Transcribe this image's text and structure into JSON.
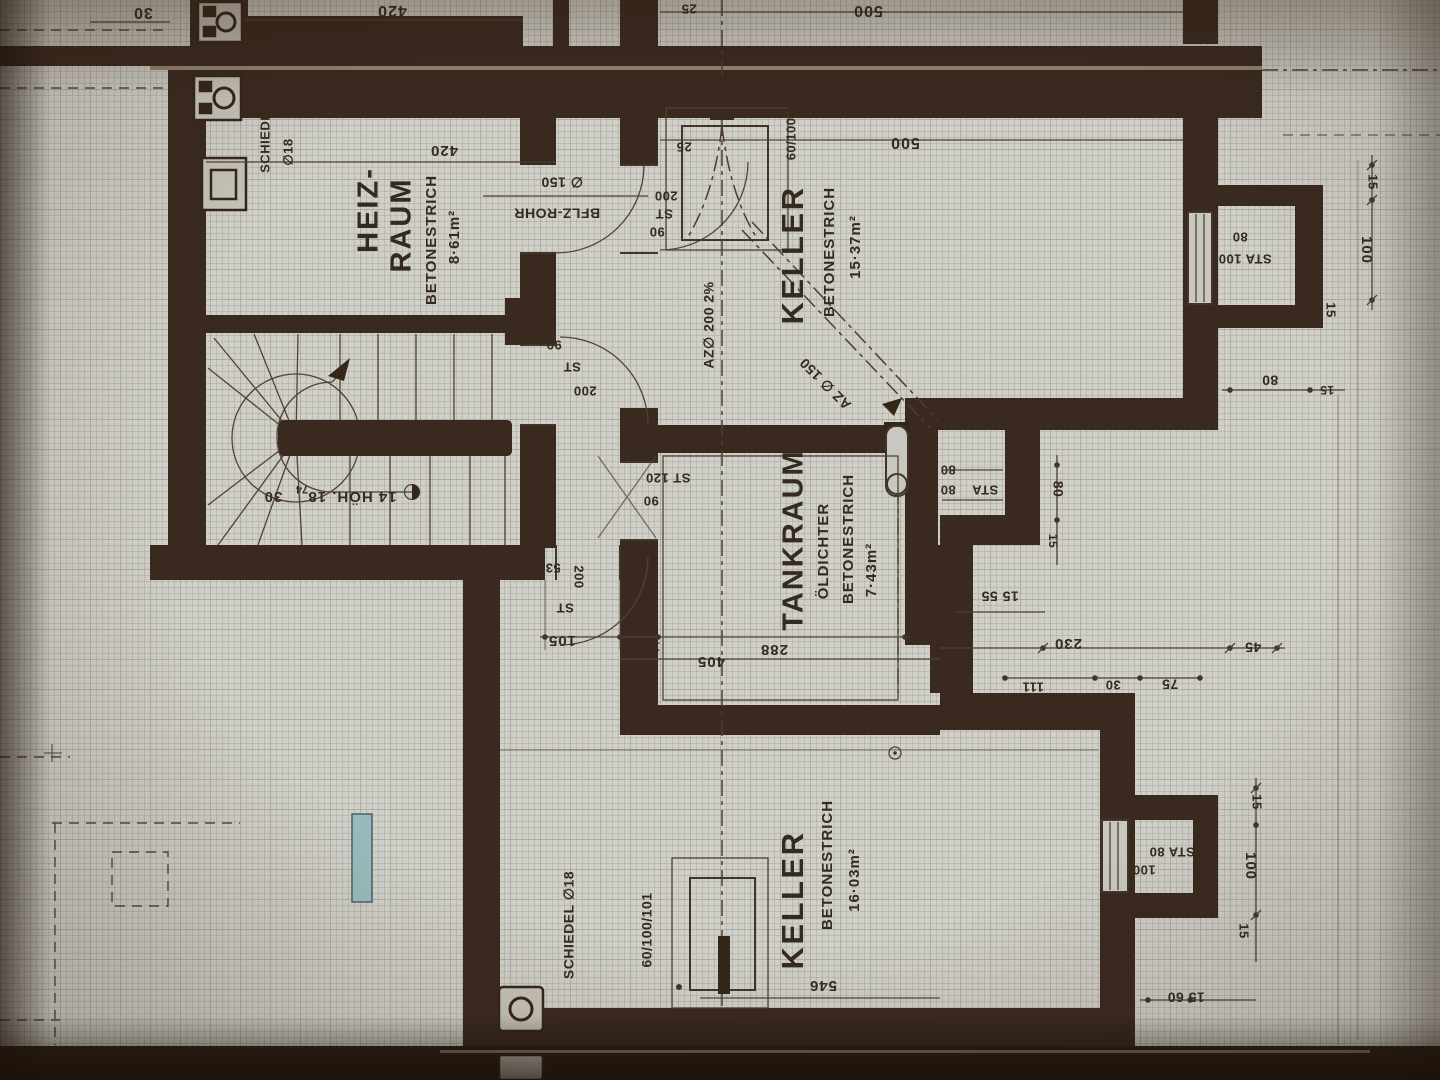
{
  "document": {
    "kind": "Basement floor plan (photographed architectural drawing, German labels)"
  },
  "rooms": {
    "heizraum": {
      "name_l1": "HEIZ-",
      "name_l2": "RAUM",
      "floor": "BETONESTRICH",
      "area": "8·61m²"
    },
    "keller_top": {
      "name": "KELLER",
      "floor": "BETONESTRICH",
      "area": "15·37m²"
    },
    "tankraum": {
      "name": "TANKRAUM",
      "spec": "ÖLDICHTER",
      "floor": "BETONESTRICH",
      "area": "7·43m²"
    },
    "keller_bottom": {
      "name": "KELLER",
      "floor": "BETONESTRICH",
      "area": "16·03m²"
    }
  },
  "stair": {
    "note_main": "14 HÖH. 18",
    "note_sup": "74",
    "note_tread": "30"
  },
  "chimneys": {
    "top_l1": "SCHIEDEL",
    "top_l2": "∅18",
    "bottom": "SCHIEDEL ∅18"
  },
  "doors": {
    "keller_top": {
      "l1": "200",
      "l2": "ST",
      "l3": "90"
    },
    "corridor_upper": {
      "l1": "90",
      "l2": "ST",
      "l3": "200"
    },
    "tankraum": {
      "l1": "ST 120",
      "l2": "90"
    },
    "corridor_lower": {
      "l1": "53",
      "l2": "200",
      "l3": "ST"
    }
  },
  "pipes": {
    "floor_pipe": "BFLZ-ROHR",
    "floor_pipe_dia": "∅ 150",
    "downpipe": "AZ∅ 200  2%",
    "branch": "AZ ∅ 150"
  },
  "fixtures": {
    "keller_top_duct": "60/100/1",
    "keller_bottom_duct": "60/100/101"
  },
  "shafts": {
    "top_right": {
      "row1": "80",
      "row2": "STA 100"
    },
    "mid_right": {
      "sta": "STA",
      "v1": "80",
      "v2": "80"
    },
    "bottom_right": {
      "row1": "STA 80",
      "row2": "100"
    }
  },
  "dimensions": {
    "top_strip": {
      "d30": "30",
      "d420": "420",
      "d25": "25",
      "d500": "500"
    },
    "heizraum_width": "420",
    "keller_top_width": "500",
    "keller_top_wall": "25",
    "corridor": {
      "d105": "105",
      "d12": "12",
      "d405": "405",
      "d288": "288"
    },
    "mid_chain": {
      "d80": "80",
      "d15a": "15",
      "d15_55": "15 55",
      "d230": "230",
      "d45": "45",
      "d111": "111",
      "d30": "30",
      "d75": "75"
    },
    "right_top_chain": {
      "d15a": "15",
      "d100": "100",
      "d15b": "15",
      "d80": "80",
      "d15c": "15"
    },
    "right_bottom_chain": {
      "d15a": "15",
      "d100": "100",
      "d15b": "15",
      "d15_60": "15 60"
    },
    "keller_bottom_width": "546"
  }
}
